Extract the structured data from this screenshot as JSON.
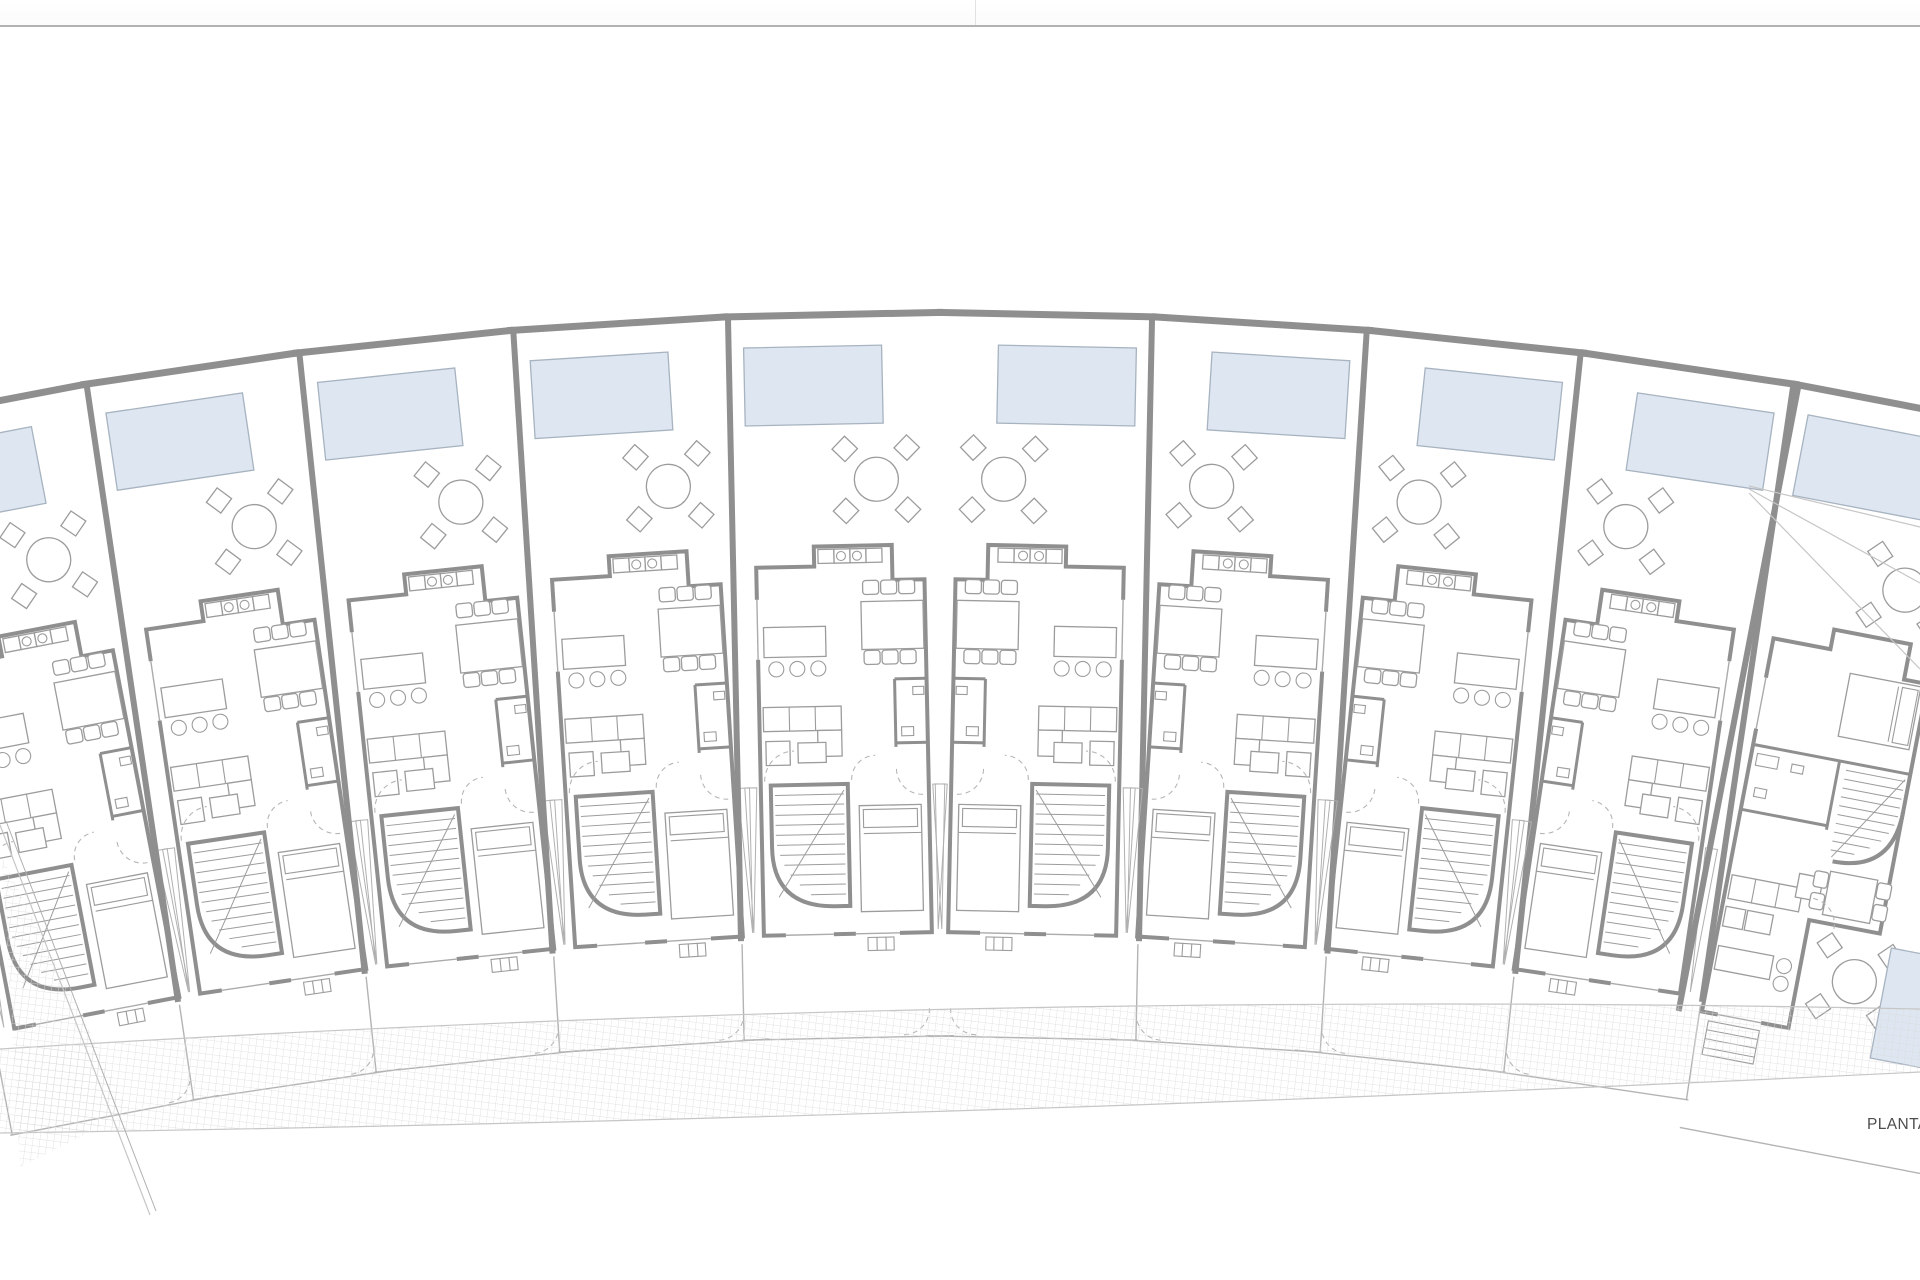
{
  "document": {
    "label": "PLANTA"
  },
  "colors": {
    "wall": "#8f8f8f",
    "wall_light": "#b3b3b3",
    "line": "#9c9c9c",
    "pool_fill": "#dde6f1",
    "pool_border": "#a7b3c0",
    "hatch": "#dadada",
    "fence": "#b3b3b3",
    "boundary": "#c6c6c6",
    "text": "#4d4d4d",
    "divider": "#b2b2b2",
    "topbar_bg": "#fbfbfb",
    "paper": "#ffffff"
  },
  "site_plan": {
    "type": "architectural-site-plan",
    "arrangement": "row of attached townhouses arranged in a fan/arc facing a curved hatched walkway",
    "unit_count": 10,
    "regular_unit_count": 8,
    "units": [
      {
        "id": "unit-01",
        "kind": "townhouse",
        "visibility": "partial-cropped-left",
        "features": [
          "pool"
        ]
      },
      {
        "id": "unit-02",
        "kind": "townhouse",
        "features": [
          "pool",
          "terrace-dining-set",
          "kitchen-island",
          "dining-table",
          "sofa",
          "staircase",
          "bathroom",
          "bedroom",
          "front-yard"
        ]
      },
      {
        "id": "unit-03",
        "kind": "townhouse",
        "features": [
          "pool",
          "terrace-dining-set",
          "kitchen-island",
          "dining-table",
          "sofa",
          "staircase",
          "bathroom",
          "bedroom",
          "front-yard"
        ]
      },
      {
        "id": "unit-04",
        "kind": "townhouse",
        "features": [
          "pool",
          "terrace-dining-set",
          "kitchen-island",
          "dining-table",
          "sofa",
          "staircase",
          "bathroom",
          "bedroom",
          "front-yard"
        ]
      },
      {
        "id": "unit-05",
        "kind": "townhouse",
        "features": [
          "pool",
          "terrace-dining-set",
          "kitchen-island",
          "dining-table",
          "sofa",
          "staircase",
          "bathroom",
          "bedroom",
          "front-yard"
        ]
      },
      {
        "id": "unit-06",
        "kind": "townhouse-mirrored",
        "features": [
          "pool",
          "terrace-dining-set",
          "kitchen-island",
          "dining-table",
          "sofa",
          "staircase",
          "bathroom",
          "bedroom",
          "front-yard"
        ]
      },
      {
        "id": "unit-07",
        "kind": "townhouse-mirrored",
        "features": [
          "pool",
          "terrace-dining-set",
          "kitchen-island",
          "dining-table",
          "sofa",
          "staircase",
          "bathroom",
          "bedroom",
          "front-yard"
        ]
      },
      {
        "id": "unit-08",
        "kind": "townhouse-mirrored",
        "features": [
          "pool",
          "terrace-dining-set",
          "kitchen-island",
          "dining-table",
          "sofa",
          "staircase",
          "bathroom",
          "bedroom",
          "front-yard"
        ]
      },
      {
        "id": "unit-09",
        "kind": "townhouse-mirrored",
        "features": [
          "pool",
          "terrace-dining-set",
          "kitchen-island",
          "dining-table",
          "sofa",
          "staircase",
          "bathroom",
          "bedroom",
          "front-yard"
        ]
      },
      {
        "id": "unit-10",
        "kind": "corner-townhouse",
        "visibility": "partial-cropped-right",
        "features": [
          "pool",
          "terrace-dining-set",
          "bedroom",
          "bathroom",
          "curved-staircase",
          "sofa",
          "kitchen-island",
          "dining-table",
          "side-terrace",
          "second-pool",
          "outdoor-steps"
        ]
      }
    ],
    "walkway": {
      "style": "hatched-paving",
      "shape": "curved band along the front of the row"
    },
    "boundary": {
      "left": "diagonal plot boundary line",
      "top": "continuous segmented boundary wall"
    }
  }
}
